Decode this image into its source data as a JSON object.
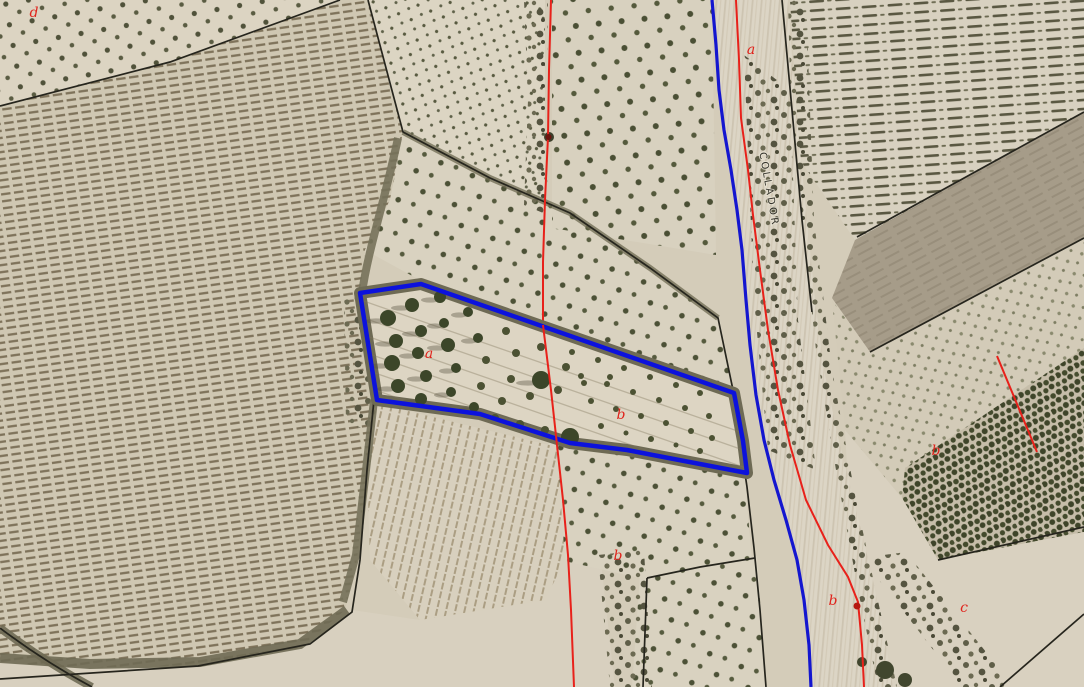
{
  "map": {
    "type": "aerial-orthophoto-with-cadastral-overlay",
    "road_label": "COLLADOR",
    "labels": [
      {
        "text": "d",
        "x": 34,
        "y": 17
      },
      {
        "text": "a",
        "x": 751,
        "y": 54
      },
      {
        "text": "a",
        "x": 429,
        "y": 358
      },
      {
        "text": "b",
        "x": 621,
        "y": 419
      },
      {
        "text": "b",
        "x": 618,
        "y": 560
      },
      {
        "text": "b",
        "x": 833,
        "y": 605
      },
      {
        "text": "b",
        "x": 936,
        "y": 455
      },
      {
        "text": "c",
        "x": 964,
        "y": 612
      }
    ],
    "colors": {
      "parcel_outline_blue": "#0c12dc",
      "road_line_blue": "#1416cf",
      "cadastral_red": "#e8211a",
      "label_red": "#e0241c",
      "boundary_black": "#26251d",
      "road_name_color": "#34332b",
      "soil_light": "#d8d0bf",
      "soil_mid": "#cfc7b2",
      "vegetation_dark": "#4a5034"
    },
    "red_dot_markers": [
      {
        "x": 549,
        "y": 137
      },
      {
        "x": 857,
        "y": 606
      }
    ]
  }
}
